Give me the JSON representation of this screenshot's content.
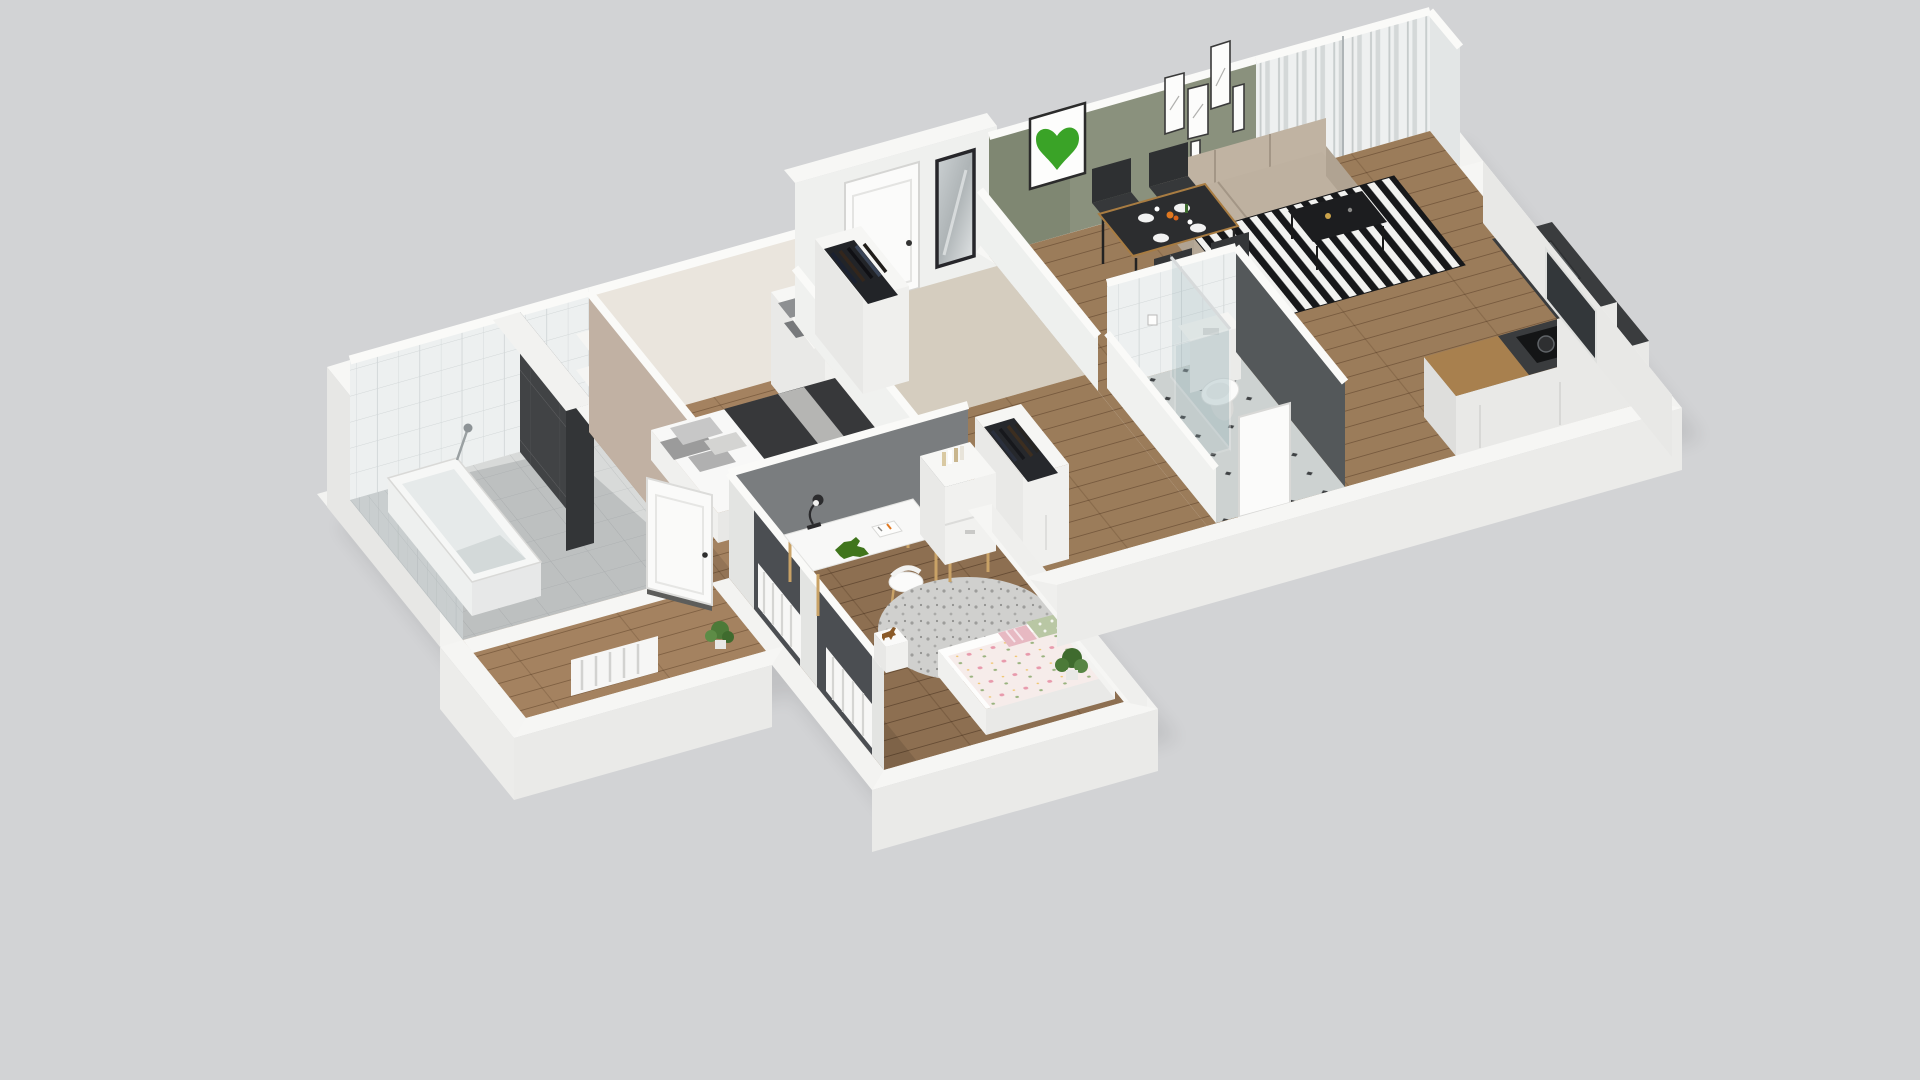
{
  "scene": {
    "title": "3D isometric cutaway floor plan render of an apartment",
    "view": "axonometric cutaway, no visible text or UI controls",
    "background": "#d2d3d5"
  },
  "palette": {
    "background": "#d2d3d5",
    "outer_wall": "#f3f3f1",
    "wall_white": "#eff0ee",
    "green_wall": "#8a917d",
    "taupe_wall": "#c1b1a3",
    "gray_wall": "#7a7d7f",
    "dark_tile": "#414345",
    "wood_bedroom": "#a48260",
    "wood_kids": "#8d6f51",
    "wood_living": "#9b7c5a",
    "hall_beige": "#d5cdbf",
    "sofa": "#b6a998",
    "dining_table": "#2c2d2f",
    "rug_stripe_dark": "#17181a",
    "rug_stripe_light": "#f2f2f0",
    "heart_green": "#3aa327",
    "kid_blanket": "#f6ecea"
  },
  "rooms": [
    {
      "name": "bathroom",
      "furniture": [
        "bathtub",
        "handheld-shower",
        "dark-tile-accent-wall",
        "white-tile-walls",
        "wall-shelves",
        "potted-plant",
        "towels"
      ]
    },
    {
      "name": "bedroom",
      "furniture": [
        "double-bed",
        "gray-pillows",
        "dark-blanket",
        "storage-shelf-with-boxes",
        "open-clothes-rack",
        "dresser-with-books",
        "open-door"
      ]
    },
    {
      "name": "hallway",
      "furniture": [
        "entry-door",
        "wall-mirror",
        "open-wardrobe-clothes-rack",
        "lower-closet",
        "fridge-with-snowflake-top"
      ]
    },
    {
      "name": "wc-shower-room",
      "furniture": [
        "toilet",
        "cistern-ledge",
        "toilet-paper-holder",
        "glass-shower-screen",
        "diamond-tile-floor"
      ]
    },
    {
      "name": "living-room",
      "furniture": [
        "three-seat-sofa",
        "dining-table-with-tableware",
        "four-dark-chairs",
        "black-white-striped-rug",
        "black-coffee-table",
        "green-heart-artwork",
        "gallery-picture-frames",
        "window-with-sheer-curtains"
      ]
    },
    {
      "name": "kitchen",
      "furniture": [
        "wood-counter",
        "dark-counter",
        "cooktop-with-pots",
        "sink-with-faucet"
      ]
    },
    {
      "name": "kids-room",
      "furniture": [
        "white-desk",
        "desk-lamp",
        "toy-dinosaur",
        "open-book",
        "white-chair",
        "round-shaggy-rug",
        "bookshelf-cabinet",
        "kids-bed-floral-blanket",
        "polka-dot-pillow",
        "striped-pillow",
        "stool-with-toy-horse",
        "radiators",
        "dark-curtain-panels",
        "potted-plant"
      ]
    }
  ]
}
